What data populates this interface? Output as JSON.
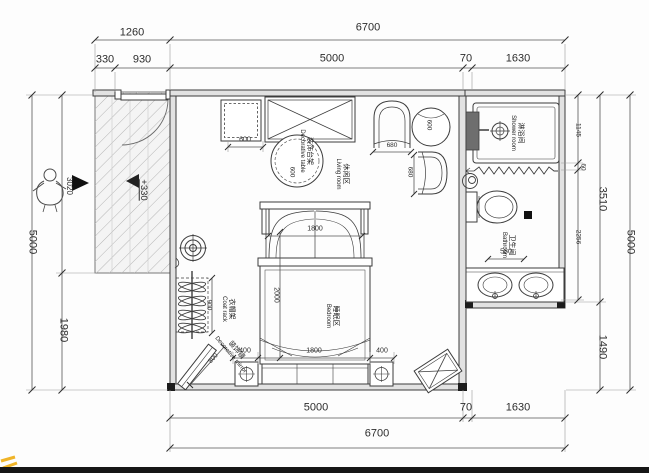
{
  "colors": {
    "line": "#3c3c3c",
    "wall_fill": "#e2e2e2",
    "dark_panel": "#6e6e6e",
    "watermark_yellow": "#f0b428",
    "bottom_bar": "#161616"
  },
  "dims": {
    "top": {
      "overall": "6700",
      "porch": "1260",
      "porch_a": "330",
      "porch_b": "930",
      "room": "5000",
      "wall": "70",
      "bath": "1630"
    },
    "bottom": {
      "room": "5000",
      "wall": "70",
      "bath": "1630",
      "overall": "6700"
    },
    "left": {
      "overall": "5000",
      "upper": "3020",
      "lower": "1980"
    },
    "right": {
      "overall": "5000",
      "block": "3510",
      "below": "1490",
      "shower": "1145",
      "gap": "60",
      "bath": "2256"
    },
    "interior": {
      "cabinet": "600",
      "chair_w": "680",
      "chair_h": "680",
      "side_table": "600",
      "decor_table": "600",
      "bed_w": "1800",
      "bed_l": "2000",
      "foot_left": "400",
      "foot_mid": "1800",
      "foot_right": "400",
      "coat_rack": "900",
      "mirror": "800",
      "vanity": "580"
    },
    "level": "+330"
  },
  "rooms": {
    "living": {
      "zh": "休闲区",
      "en": "Living room"
    },
    "bedroom": {
      "zh": "睡眠区",
      "en": "Bedroom"
    },
    "shower": {
      "zh": "淋浴间",
      "en": "Shower room"
    },
    "bathroom": {
      "zh": "卫生间",
      "en": "Bathroom"
    }
  },
  "furniture": {
    "coat_rack": {
      "zh": "衣帽架",
      "en": "Coat rack"
    },
    "mirror": {
      "zh": "装饰镜",
      "en": "Decorative mirror"
    },
    "decor_table": {
      "zh": "装饰台架",
      "en": "Decorative table"
    }
  }
}
